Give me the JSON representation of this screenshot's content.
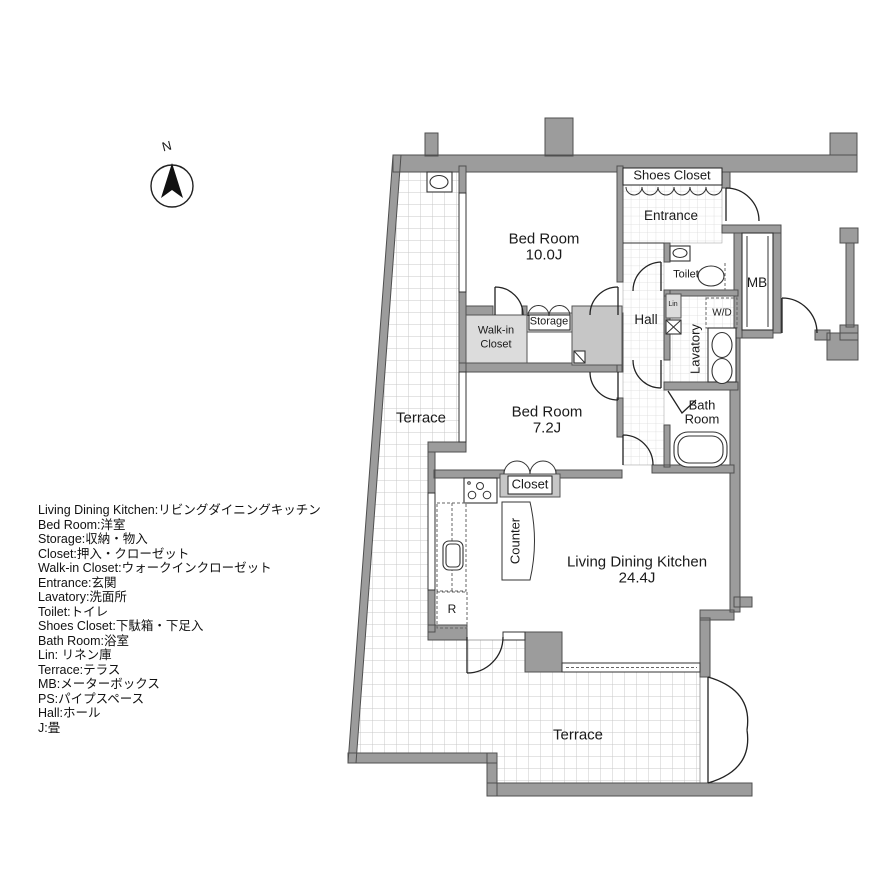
{
  "compass": {
    "label": "N"
  },
  "plan": {
    "bedroom1": {
      "name": "Bed Room",
      "size": "10.0J"
    },
    "bedroom2": {
      "name": "Bed Room",
      "size": "7.2J"
    },
    "ldk": {
      "name": "Living Dining Kitchen",
      "size": "24.4J"
    },
    "terrace_upper": "Terrace",
    "terrace_lower": "Terrace",
    "shoes_closet": "Shoes Closet",
    "entrance": "Entrance",
    "toilet": "Toilet",
    "hall": "Hall",
    "lavatory": "Lavatory",
    "bath_room": {
      "line1": "Bath",
      "line2": "Room"
    },
    "walk_in_closet": {
      "line1": "Walk-in",
      "line2": "Closet"
    },
    "storage": "Storage",
    "closet": "Closet",
    "counter": "Counter",
    "mb": "MB",
    "wd": "W/D",
    "lin": "Lin",
    "refrigerator": "R"
  },
  "legend": {
    "items": [
      "Living Dining Kitchen:リビングダイニングキッチン",
      "Bed Room:洋室",
      "Storage:収納・物入",
      "Closet:押入・クローゼット",
      "Walk-in Closet:ウォークインクローゼット",
      "Entrance:玄関",
      "Lavatory:洗面所",
      "Toilet:トイレ",
      "Shoes Closet:下駄箱・下足入",
      "Bath Room:浴室",
      "Lin: リネン庫",
      "Terrace:テラス",
      "MB:メーターボックス",
      "PS:パイプスペース",
      "Hall:ホール",
      "J:畳"
    ]
  },
  "colors": {
    "wall": "#9c9c9c",
    "wall_edge": "#4f4f4f",
    "grid_terrace": "#c9c9c9",
    "grid_tile": "#dadada",
    "shade_light": "#dcdcdc",
    "shade_mid": "#c6c6c6"
  }
}
